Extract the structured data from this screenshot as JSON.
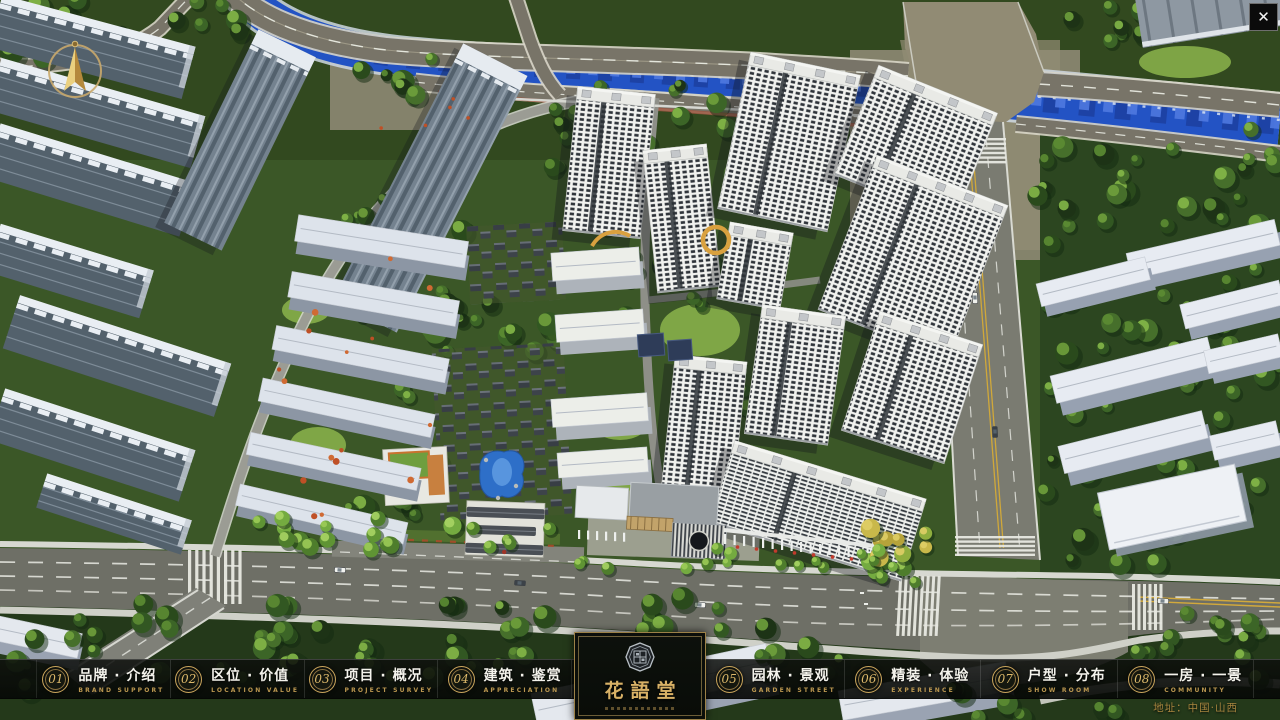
{
  "window": {
    "close_glyph": "✕"
  },
  "nav": {
    "items": [
      {
        "num": "01",
        "cn": "品牌 · 介绍",
        "en": "BRAND SUPPORT"
      },
      {
        "num": "02",
        "cn": "区位 · 价值",
        "en": "LOCATION VALUE"
      },
      {
        "num": "03",
        "cn": "项目 · 概况",
        "en": "PROJECT SURVEY"
      },
      {
        "num": "04",
        "cn": "建筑 · 鉴赏",
        "en": "APPRECIATION"
      },
      {
        "num": "05",
        "cn": "园林 · 景观",
        "en": "GARDEN STREET"
      },
      {
        "num": "06",
        "cn": "精装 · 体验",
        "en": "EXPERIENCE"
      },
      {
        "num": "07",
        "cn": "户型 · 分布",
        "en": "SHOW ROOM"
      },
      {
        "num": "08",
        "cn": "一房 · 一景",
        "en": "COMMUNITY"
      }
    ]
  },
  "logo": {
    "name": "花語堂"
  },
  "footer": {
    "address": "地址：中国·山西"
  }
}
